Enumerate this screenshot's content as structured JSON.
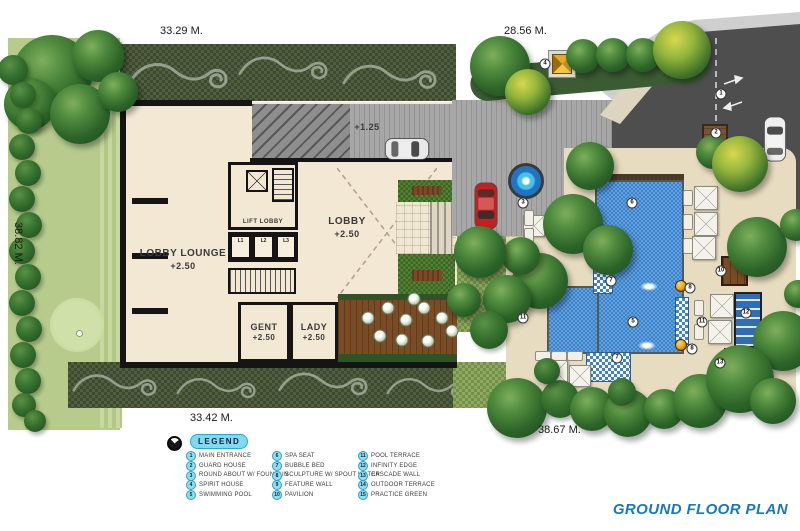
{
  "title": "GROUND FLOOR PLAN",
  "dimensions": {
    "top": "33.29 M.",
    "top_right": "28.56 M.",
    "left": "38.82 M.",
    "bottom": "33.42 M.",
    "bottom_right": "38.67 M."
  },
  "building": {
    "lobby_lounge_name": "LOBBY LOUNGE",
    "lobby_lounge_level": "+2.50",
    "lift_lobby_name": "LIFT LOBBY",
    "lobby_name": "LOBBY",
    "lobby_level": "+2.50",
    "gent_name": "GENT",
    "gent_level": "+2.50",
    "lady_name": "LADY",
    "lady_level": "+2.50",
    "driveway_level": "+1.25",
    "lifts": [
      "L1",
      "L2",
      "L3"
    ]
  },
  "legend": {
    "title": "LEGEND",
    "items": [
      {
        "num": "1",
        "label": "MAIN ENTRANCE"
      },
      {
        "num": "2",
        "label": "GUARD HOUSE"
      },
      {
        "num": "3",
        "label": "ROUND ABOUT W/ FOUNTAIN"
      },
      {
        "num": "4",
        "label": "SPIRIT HOUSE"
      },
      {
        "num": "5",
        "label": "SWIMMING POOL"
      },
      {
        "num": "6",
        "label": "SPA SEAT"
      },
      {
        "num": "7",
        "label": "BUBBLE BED"
      },
      {
        "num": "8",
        "label": "SCULPTURE W/ SPOUT WATER"
      },
      {
        "num": "9",
        "label": "FEATURE WALL"
      },
      {
        "num": "10",
        "label": "PAVILION"
      },
      {
        "num": "11",
        "label": "POOL TERRACE"
      },
      {
        "num": "12",
        "label": "INFINITY EDGE"
      },
      {
        "num": "13",
        "label": "CASCADE WALL"
      },
      {
        "num": "14",
        "label": "OUTDOOR TERRACE"
      },
      {
        "num": "15",
        "label": "PRACTICE GREEN"
      }
    ]
  },
  "plan_markers": [
    {
      "num": "1",
      "x": 721,
      "y": 94
    },
    {
      "num": "2",
      "x": 716,
      "y": 133
    },
    {
      "num": "3",
      "x": 523,
      "y": 203
    },
    {
      "num": "4",
      "x": 545,
      "y": 64
    },
    {
      "num": "5",
      "x": 633,
      "y": 322
    },
    {
      "num": "6",
      "x": 632,
      "y": 203
    },
    {
      "num": "7",
      "x": 611,
      "y": 281
    },
    {
      "num": "7",
      "x": 617,
      "y": 358
    },
    {
      "num": "8",
      "x": 690,
      "y": 288
    },
    {
      "num": "8",
      "x": 692,
      "y": 349
    },
    {
      "num": "10",
      "x": 721,
      "y": 271
    },
    {
      "num": "11",
      "x": 523,
      "y": 318
    },
    {
      "num": "11",
      "x": 702,
      "y": 322
    },
    {
      "num": "12",
      "x": 746,
      "y": 313
    },
    {
      "num": "13",
      "x": 720,
      "y": 363
    }
  ],
  "icons": {
    "compass": "compass-icon",
    "arrow_in": "→",
    "arrow_out": "←",
    "umbrella": "umbrella-icon"
  },
  "colors": {
    "title_blue": "#1878b8",
    "legend_cyan": "#7fd9f2",
    "pool_blue": "#3f84c8",
    "deck_sand": "#e8dcc0",
    "road_dark": "#4e4e4e",
    "grass_dark": "#46523a",
    "grass_light": "#b7cc8c"
  }
}
